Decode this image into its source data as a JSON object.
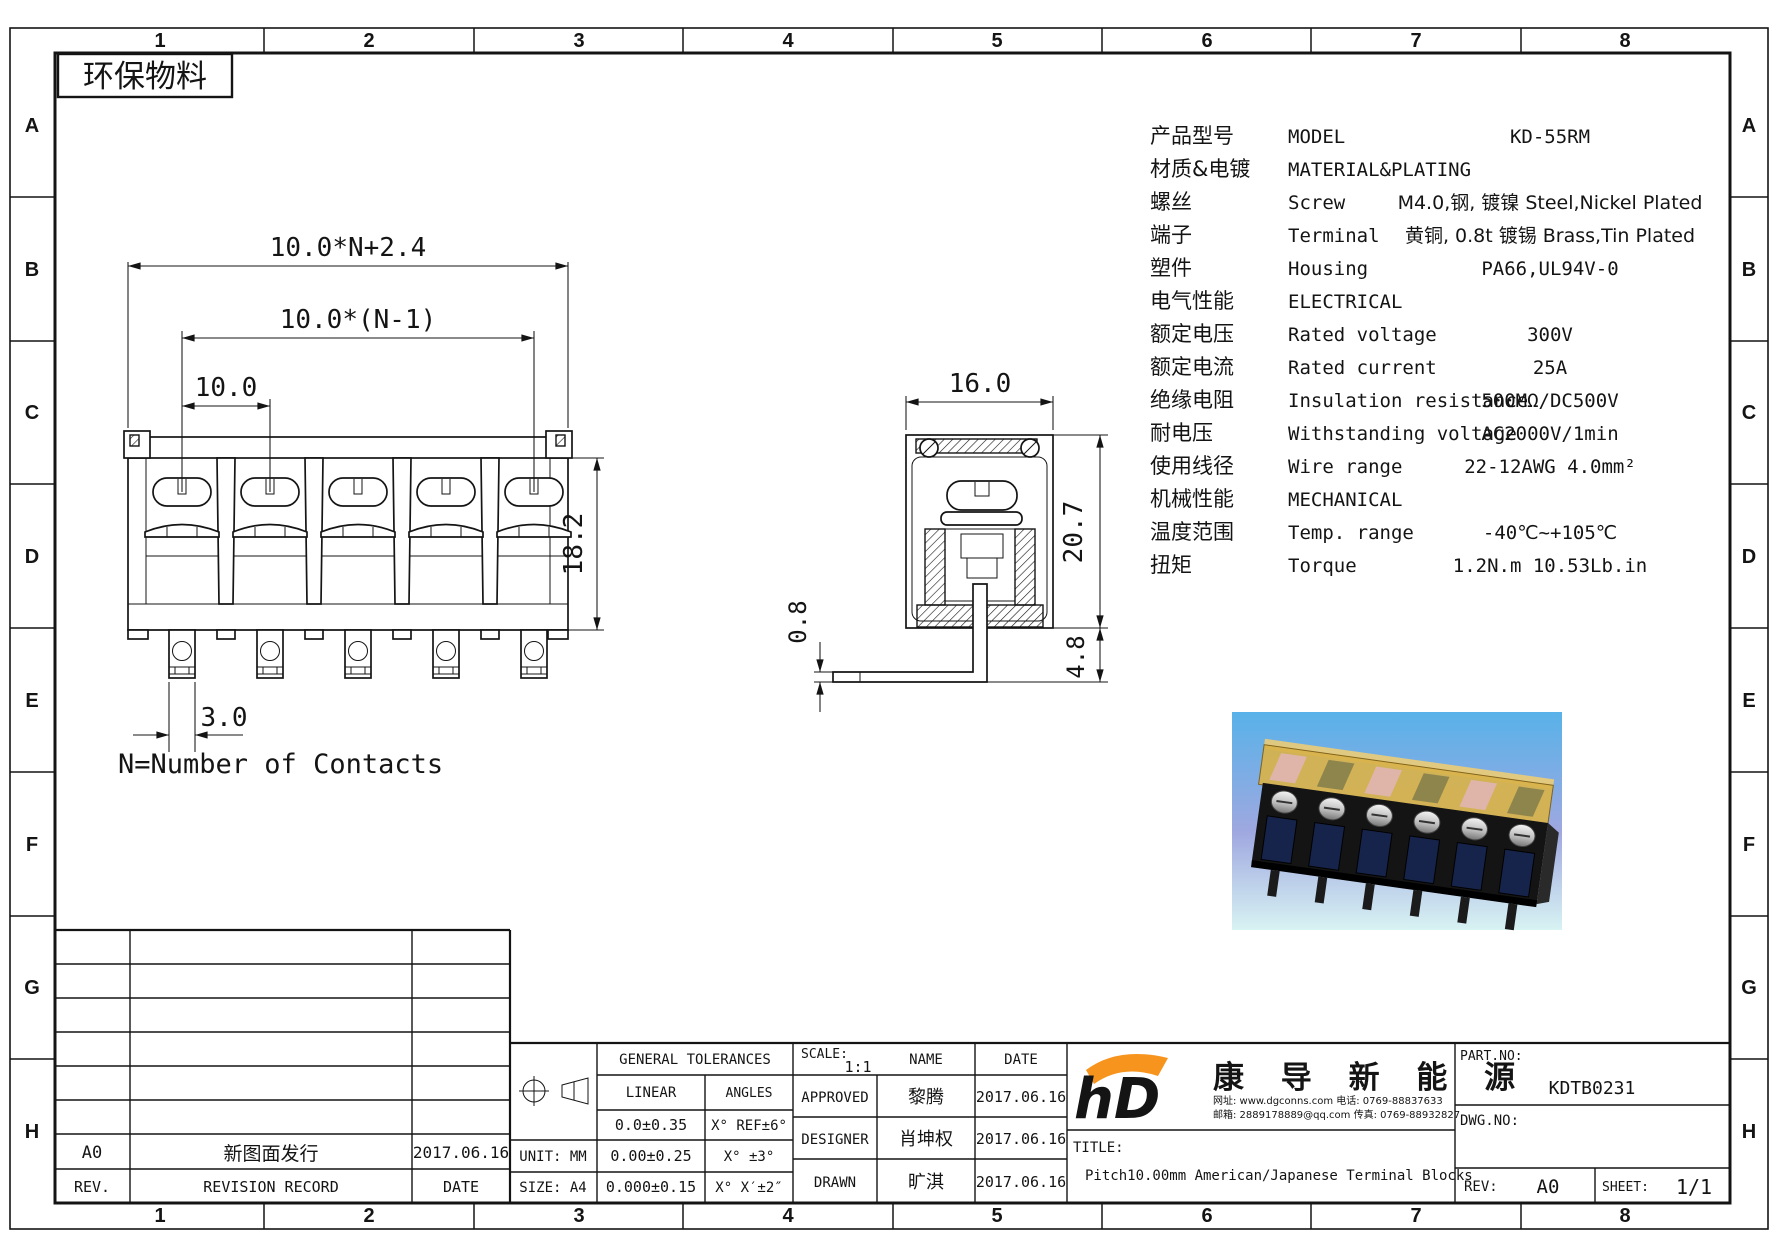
{
  "sheet": {
    "eco_label": "环保物料",
    "note": "N=Number of Contacts"
  },
  "border": {
    "columns": [
      "1",
      "2",
      "3",
      "4",
      "5",
      "6",
      "7",
      "8"
    ],
    "rows": [
      "A",
      "B",
      "C",
      "D",
      "E",
      "F",
      "G",
      "H"
    ]
  },
  "spec": {
    "rows": [
      {
        "cn": "产品型号",
        "en": "MODEL",
        "val": "KD-55RM"
      },
      {
        "cn": "材质&电镀",
        "en": "MATERIAL&PLATING",
        "val": ""
      },
      {
        "cn": "螺丝",
        "en": "Screw",
        "val": "M4.0,钢, 镀镍 Steel,Nickel Plated"
      },
      {
        "cn": "端子",
        "en": "Terminal",
        "val": "黄铜, 0.8t 镀锡 Brass,Tin Plated"
      },
      {
        "cn": "塑件",
        "en": "Housing",
        "val": "PA66,UL94V-0"
      },
      {
        "cn": "电气性能",
        "en": "ELECTRICAL",
        "val": ""
      },
      {
        "cn": "额定电压",
        "en": "Rated voltage",
        "val": "300V"
      },
      {
        "cn": "额定电流",
        "en": "Rated current",
        "val": "25A"
      },
      {
        "cn": "绝缘电阻",
        "en": "Insulation resistance",
        "val": "500MΩ/DC500V"
      },
      {
        "cn": "耐电压",
        "en": "Withstanding voltage",
        "val": "AC2000V/1min"
      },
      {
        "cn": "使用线径",
        "en": "Wire range",
        "val": "22-12AWG 4.0mm²"
      },
      {
        "cn": "机械性能",
        "en": "MECHANICAL",
        "val": ""
      },
      {
        "cn": "温度范围",
        "en": "Temp. range",
        "val": "-40℃~+105℃"
      },
      {
        "cn": "扭矩",
        "en": "Torque",
        "val": "1.2N.m  10.53Lb.in"
      }
    ]
  },
  "front_view": {
    "dim_overall": "10.0*N+2.4",
    "dim_span": "10.0*(N-1)",
    "dim_pitch": "10.0",
    "dim_height": "18.2",
    "dim_pin_width": "3.0"
  },
  "side_view": {
    "dim_width": "16.0",
    "dim_height": "20.7",
    "dim_pin_thickness": "0.8",
    "dim_pin_length": "4.8"
  },
  "title_block": {
    "revision": {
      "rev": "A0",
      "record": "新图面发行",
      "date": "2017.06.16",
      "rev_label": "REV.",
      "record_label": "REVISION RECORD",
      "date_label": "DATE"
    },
    "general": {
      "header": "GENERAL TOLERANCES",
      "linear_label": "LINEAR",
      "angles_label": "ANGLES",
      "linear_1": "0.0±0.35",
      "linear_2": "0.00±0.25",
      "linear_3": "0.000±0.15",
      "angles_1": "X° REF±6°",
      "angles_2": "X° ±3°",
      "angles_3": "X° X′±2″",
      "unit": "UNIT: MM",
      "size": "SIZE: A4"
    },
    "signoff": {
      "scale_label": "SCALE:",
      "scale": "1:1",
      "name_label": "NAME",
      "date_label": "DATE",
      "approved_label": "APPROVED",
      "approved_name": "黎腾",
      "approved_date": "2017.06.16",
      "designer_label": "DESIGNER",
      "designer_name": "肖坤权",
      "designer_date": "2017.06.16",
      "drawn_label": "DRAWN",
      "drawn_name": "旷淇",
      "drawn_date": "2017.06.16"
    },
    "company": {
      "logo_text": "hD",
      "name": "康 导 新 能 源",
      "contact1": "网址: www.dgconns.com  电话: 0769-88837633",
      "contact2": "邮箱: 2889178889@qq.com 传真: 0769-88932827"
    },
    "title_label": "TITLE:",
    "title": "Pitch10.00mm American/Japanese Terminal Blocks",
    "part_label": "PART.NO:",
    "part_no": "KDTB0231",
    "dwg_label": "DWG.NO:",
    "rev_label": "REV:",
    "rev": "A0",
    "sheet_label": "SHEET:",
    "sheet_no": "1/1"
  },
  "colors": {
    "line": "#141414",
    "logo_blue": "#29abe2",
    "logo_orange": "#f7941d",
    "contact_text": "#1b2f8f",
    "photo_sky": "#58b2e9",
    "photo_lavender": "#9fa8e0",
    "photo_cyan": "#d8f3f3",
    "cover_amber": "#d9b34a"
  }
}
